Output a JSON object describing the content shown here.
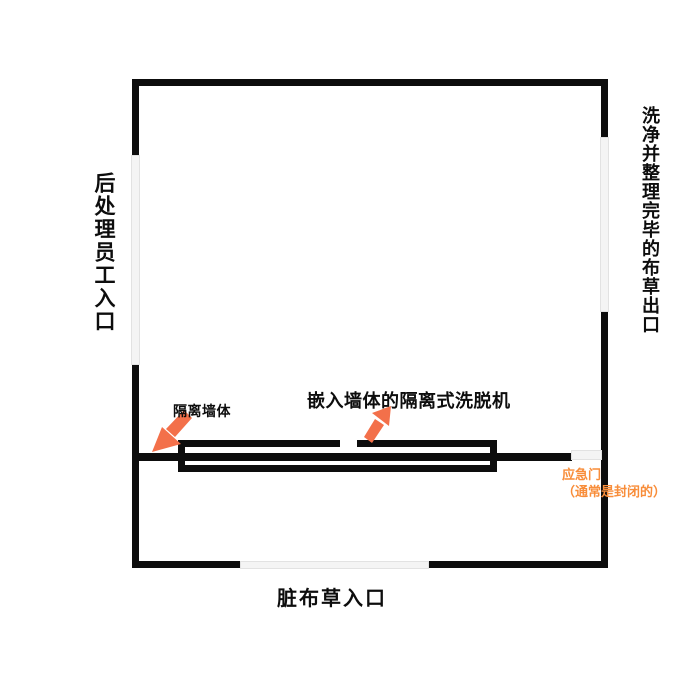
{
  "diagram": {
    "room": {
      "left_label": "后处理员工入口",
      "right_label": "洗净并整理完毕的布草出口",
      "bottom_label": "脏布草入口"
    },
    "annotations": {
      "washer_label": "嵌入墙体的隔离式洗脱机",
      "isolation_wall_label": "隔离墙体",
      "emergency_door_line1": "应急门",
      "emergency_door_line2": "（通常是封闭的）"
    },
    "icons": {
      "arrow_to_isolation_wall": "arrow-down-left-icon",
      "arrow_to_washer": "arrow-up-right-icon"
    },
    "colors": {
      "wall_black": "#0d0d0d",
      "arrow_orange": "#f3704a",
      "emergency_text_orange": "#f88d3a",
      "door_opening_gray": "#f4f4f4",
      "background": "#ffffff"
    }
  }
}
